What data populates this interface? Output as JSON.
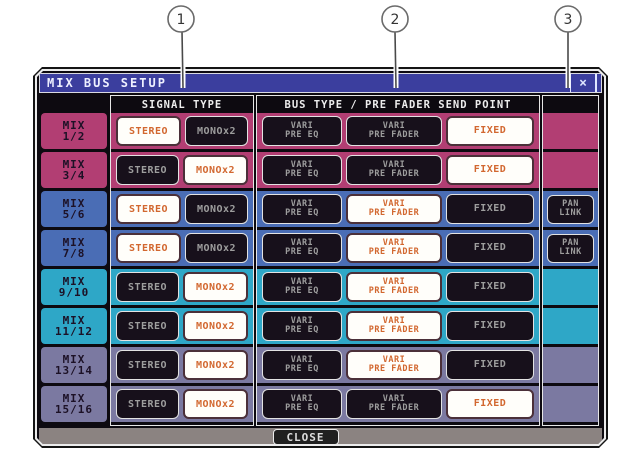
{
  "annotations": {
    "callouts": [
      {
        "label": "1",
        "cx": 181,
        "cy": 19,
        "line_x": 183,
        "line_y2": 88
      },
      {
        "label": "2",
        "cx": 395,
        "cy": 19,
        "line_x": 396,
        "line_y2": 88
      },
      {
        "label": "3",
        "cx": 568,
        "cy": 19,
        "line_x": 568,
        "line_y2": 88
      }
    ]
  },
  "window": {
    "title": "MIX BUS SETUP",
    "close_icon": "×"
  },
  "table": {
    "headers": {
      "signal": "SIGNAL TYPE",
      "bus": "BUS TYPE / PRE FADER SEND POINT"
    },
    "signal_options": [
      "STEREO",
      "MONOx2"
    ],
    "bus_options": [
      {
        "line1": "VARI",
        "line2": "PRE EQ",
        "value": "VARI PRE EQ"
      },
      {
        "line1": "VARI",
        "line2": "PRE FADER",
        "value": "VARI PRE FADER"
      },
      {
        "line1": "FIXED",
        "line2": "",
        "value": "FIXED"
      }
    ],
    "pan_link": {
      "line1": "PAN",
      "line2": "LINK"
    },
    "rows": [
      {
        "label_top": "MIX",
        "label_bottom": "1/2",
        "color": "#b23e73",
        "signal": "STEREO",
        "bus": "FIXED",
        "pan_link": false
      },
      {
        "label_top": "MIX",
        "label_bottom": "3/4",
        "color": "#b23e73",
        "signal": "MONOx2",
        "bus": "FIXED",
        "pan_link": false
      },
      {
        "label_top": "MIX",
        "label_bottom": "5/6",
        "color": "#4a6db5",
        "signal": "STEREO",
        "bus": "VARI PRE FADER",
        "pan_link": true
      },
      {
        "label_top": "MIX",
        "label_bottom": "7/8",
        "color": "#4a6db5",
        "signal": "STEREO",
        "bus": "VARI PRE FADER",
        "pan_link": true
      },
      {
        "label_top": "MIX",
        "label_bottom": "9/10",
        "color": "#2ea7c7",
        "signal": "MONOx2",
        "bus": "VARI PRE FADER",
        "pan_link": false
      },
      {
        "label_top": "MIX",
        "label_bottom": "11/12",
        "color": "#2ea7c7",
        "signal": "MONOx2",
        "bus": "VARI PRE FADER",
        "pan_link": false
      },
      {
        "label_top": "MIX",
        "label_bottom": "13/14",
        "color": "#7b79a1",
        "signal": "MONOx2",
        "bus": "VARI PRE FADER",
        "pan_link": false
      },
      {
        "label_top": "MIX",
        "label_bottom": "15/16",
        "color": "#7b79a1",
        "signal": "MONOx2",
        "bus": "FIXED",
        "pan_link": false
      }
    ]
  },
  "footer": {
    "close_label": "CLOSE"
  },
  "colors": {
    "titlebar": "#3b3e9e",
    "row_magenta": "#b23e73",
    "row_blue": "#4a6db5",
    "row_cyan": "#2ea7c7",
    "row_gray": "#7b79a1",
    "active_text": "#d2672f",
    "inactive_text": "#9e9e9e",
    "button_dark": "#17101b",
    "footer_bg": "#8b8381"
  }
}
